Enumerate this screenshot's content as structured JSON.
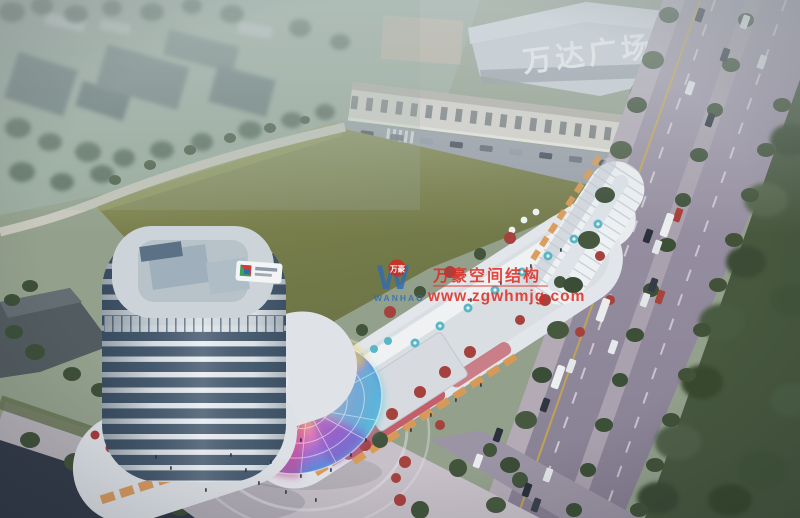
{
  "scene": {
    "type": "aerial-architectural-rendering",
    "time_of_day": "dusk",
    "description": "Bird's-eye architectural rendering of a mixed-use commercial complex: a white banded tower, a curved retail podium with an iridescent glass dome, rooftop terraces with teal umbrellas, a large green field, tree-lined avenues with traffic, and the Wanda Plaza mall in the hazy background."
  },
  "signs": {
    "background_mall": "万达广场"
  },
  "watermark": {
    "monogram": "W",
    "monogram_badge": "万豪",
    "logo_caption": "WANHAO",
    "brand_cn": "万豪空间结构",
    "url": "www.zgwhmjg.com",
    "text_color": "#e02a1e",
    "logo_color": "#2e6bb4"
  },
  "palette": {
    "haze": "#b5c0c2",
    "field_green": "#7d824f",
    "road_gray": "#958da0",
    "dark_road": "#333b49",
    "tower_glass": "#4a5e72",
    "tower_band": "#e9edf1",
    "dome_pink": "#e06aa8",
    "dome_blue": "#5f8ad8",
    "dome_yellow": "#e8d35e",
    "tree_green": "#3f5138",
    "accent_tree_red": "#a6423e",
    "umbrella_teal": "#58b7c6",
    "shop_glow": "#d99a55"
  }
}
